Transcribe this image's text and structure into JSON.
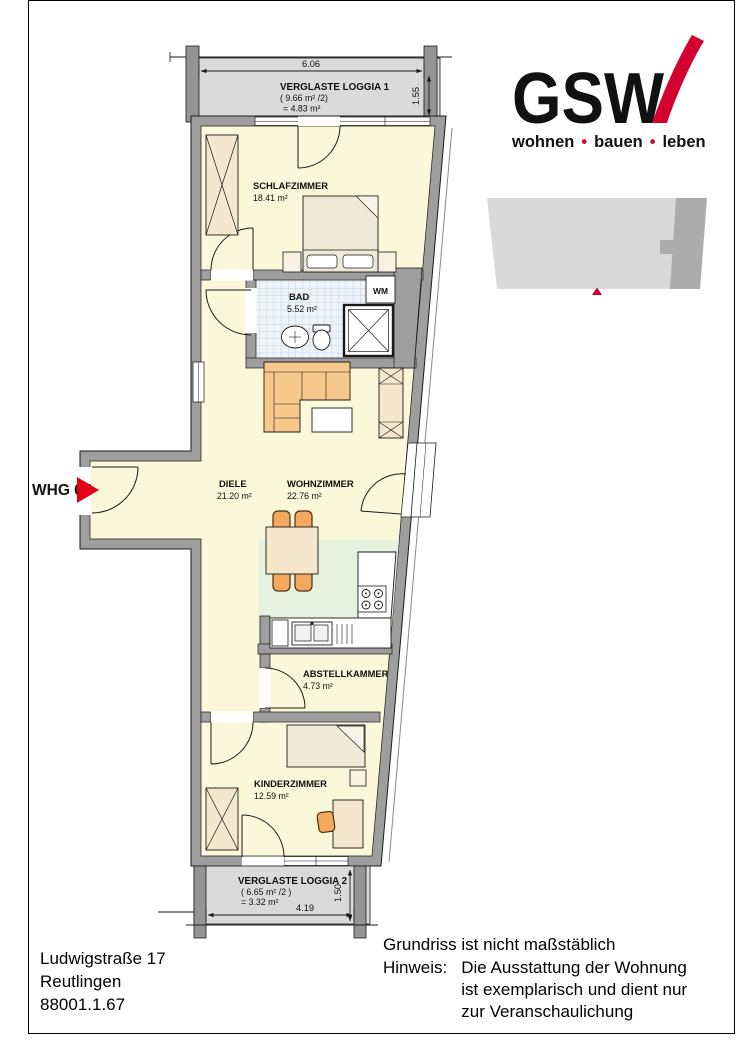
{
  "logo": {
    "text": "GSW",
    "tagline": [
      "wohnen",
      "bauen",
      "leben"
    ],
    "dot": "•",
    "brand_color": "#d40030",
    "tagline_color": "#1d1d1b"
  },
  "key_plan": {
    "light_color": "#d9d9d9",
    "dark_color": "#acacac",
    "marker_color": "#c90030"
  },
  "unit_marker": {
    "label": "WHG 67",
    "text_color": "#8d8d8d",
    "arrow_color": "#e30019"
  },
  "plan": {
    "loggia1": {
      "name": "VERGLASTE LOGGIA 1",
      "calc": "( 9.66 m² /2)",
      "half": "= 4.83 m²",
      "width": "6.06",
      "depth": "1.55"
    },
    "schlafzimmer": {
      "name": "SCHLAFZIMMER",
      "area": "18.41 m²"
    },
    "bad": {
      "name": "BAD",
      "area": "5.52 m²"
    },
    "wm_label": "WM",
    "diele": {
      "name": "DIELE",
      "area": "21.20 m²"
    },
    "wohnzimmer": {
      "name": "WOHNZIMMER",
      "area": "22.76 m²"
    },
    "abstellkammer": {
      "name": "ABSTELLKAMMER",
      "area": "4.73 m²"
    },
    "kinderzimmer": {
      "name": "KINDERZIMMER",
      "area": "12.59 m²"
    },
    "loggia2": {
      "name": "VERGLASTE LOGGIA 2",
      "calc": "( 6.65 m² /2 )",
      "half": "= 3.32 m²",
      "width": "4.19",
      "depth": "1.50"
    },
    "colors": {
      "room_fill": "#fbf8d9",
      "wall_fill": "#9e9e9e",
      "loggia_floor": "#dadada",
      "kitchen_floor": "#e6f1de",
      "bath_tile": "#eef3f8",
      "furniture_wood": "#f4e7cb",
      "sofa": "#f6c88c",
      "chair": "#f2a95e"
    }
  },
  "footer": {
    "address": [
      "Ludwigstraße 17",
      "Reutlingen",
      "88001.1.67"
    ],
    "note": "Grundriss ist nicht maßstäblich",
    "hinweis_label": "Hinweis:",
    "hinweis_lines": [
      "Die Ausstattung der Wohnung",
      "ist exemplarisch und dient nur",
      "zur Veranschaulichung"
    ]
  }
}
